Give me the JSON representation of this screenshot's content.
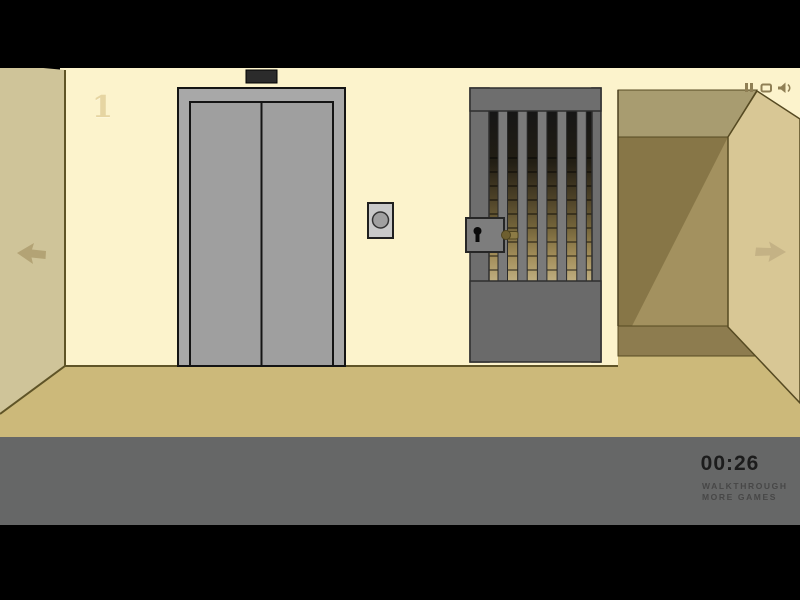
{
  "hud": {
    "floor_label": "1",
    "timer": "00:26",
    "walkthrough_label": "WALKTHROUGH",
    "more_games_label": "MORE GAMES",
    "controls": [
      "pause",
      "replay",
      "sound"
    ]
  },
  "scene": {
    "items": [
      "elevator-floor-indicator",
      "elevator-doors",
      "elevator-call-button",
      "jail-gate",
      "gate-lock",
      "gate-key-bolt",
      "corridor-opening",
      "nav-arrow-left",
      "nav-arrow-right"
    ]
  },
  "palette": {
    "background": "#000000",
    "back_wall": "#fcf3cc",
    "side_wall_left": "#cfc499",
    "side_wall_right": "#d8c795",
    "floor": "#ccb97a",
    "corridor_ceiling": "#a89c70",
    "corridor_wall": "#a3915f",
    "corridor_shadow": "#877647",
    "corridor_floor_band": "#8d7c4f",
    "elevator_metal": "#a8a8a8",
    "elevator_doors": "#9f9f9f",
    "gate_metal": "#6e6e6e",
    "hud_panel": "#666767",
    "timer_text": "#1c1c1c",
    "brass": "#8c7b45",
    "icon_olive": "#8f7f55"
  }
}
